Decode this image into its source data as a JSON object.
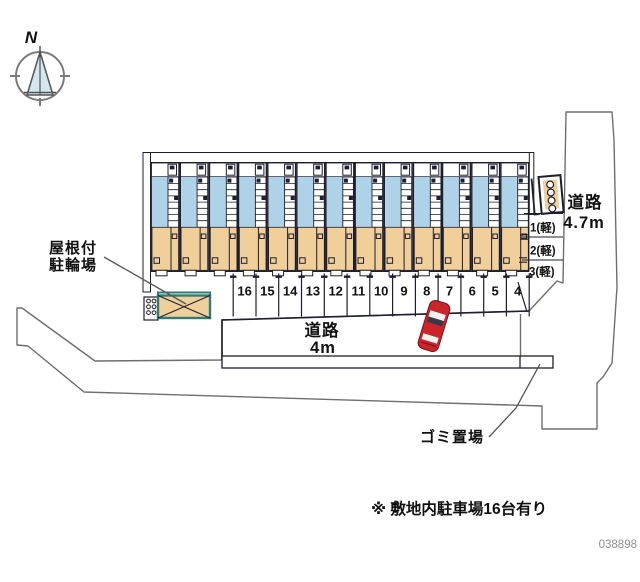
{
  "site_plan": {
    "compass": {
      "north_label": "N"
    },
    "building": {
      "unit_count": 13
    },
    "parking": {
      "space_numbers": [
        "16",
        "15",
        "14",
        "13",
        "12",
        "11",
        "10",
        "9",
        "8",
        "7",
        "6",
        "5",
        "4"
      ],
      "note": "※ 敷地内駐車場16台有り"
    },
    "kei_parking": {
      "labels": [
        "1(軽)",
        "2(軽)",
        "3(軽)"
      ]
    },
    "labels": {
      "covered_bicycle_parking_line1": "屋根付",
      "covered_bicycle_parking_line2": "駐輪場",
      "road_right_line1": "道路",
      "road_right_line2": "4.7m",
      "road_bottom_line1": "道路",
      "road_bottom_line2": "4m",
      "garbage_area": "ゴミ置場"
    },
    "drawing_number": "038898",
    "colors": {
      "road_gray": "#e5e5e7",
      "road_line": "#6e6e6e",
      "outline": "#1e1e2e",
      "unit_blue": "#aed3e8",
      "unit_tan": "#f0cf9b",
      "teal": "#2f7d72",
      "car_red": "#c9252b"
    }
  }
}
